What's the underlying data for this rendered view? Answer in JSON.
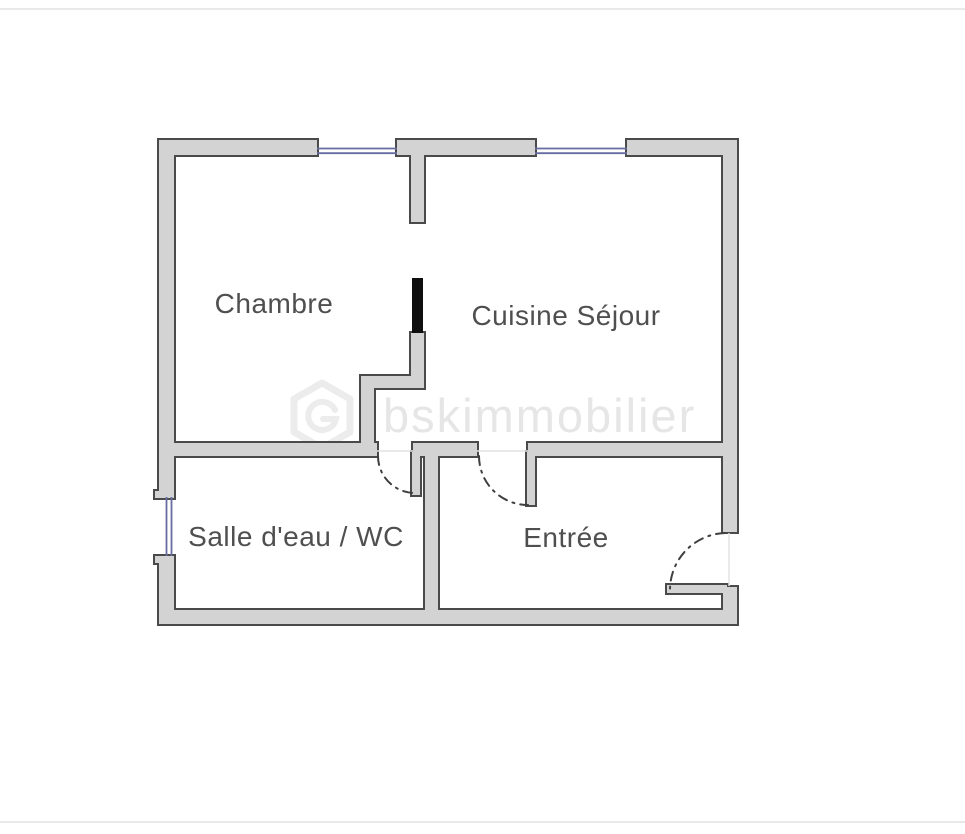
{
  "plan": {
    "rooms": [
      {
        "id": "chambre",
        "label": "Chambre"
      },
      {
        "id": "cuisine-sejour",
        "label": "Cuisine Séjour"
      },
      {
        "id": "salle-deau-wc",
        "label": "Salle d'eau / WC"
      },
      {
        "id": "entree",
        "label": "Entrée"
      }
    ],
    "watermark": {
      "text": "bskimmobilier"
    },
    "colors": {
      "background": "#ffffff",
      "wall_fill": "#d3d3d3",
      "wall_outline": "#4a4a4a",
      "window_line": "#666ca0",
      "door_leaf_black": "#0f0f0f",
      "door_arc": "#3f3f3f",
      "threshold_line": "#e2e2e2",
      "label_text": "#4f4f4f",
      "watermark_gray": "#e6e6e6"
    }
  }
}
